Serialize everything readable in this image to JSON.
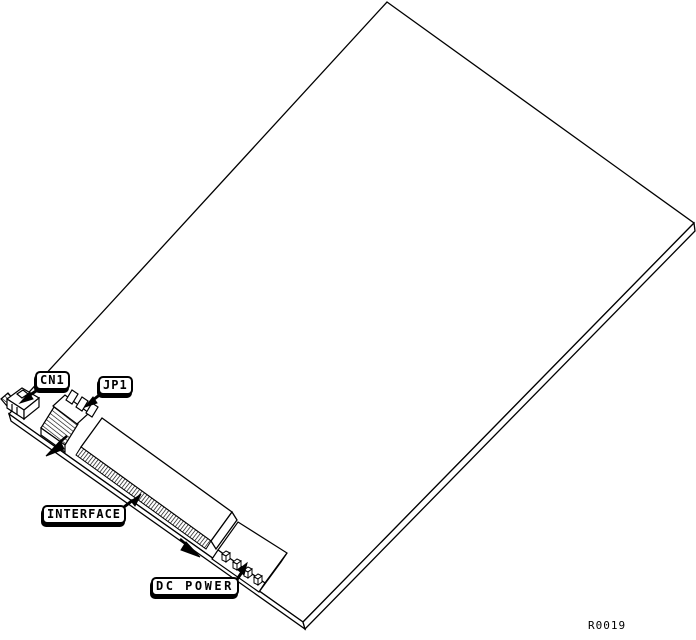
{
  "diagram": {
    "colors": {
      "line": "#000000",
      "background": "#ffffff"
    },
    "reference_code": "R0019",
    "callouts": [
      {
        "id": "cn1",
        "label": "CN1"
      },
      {
        "id": "jp1",
        "label": "JP1"
      },
      {
        "id": "interface",
        "label": "INTERFACE"
      },
      {
        "id": "dc-power",
        "label": "DC POWER"
      }
    ]
  }
}
